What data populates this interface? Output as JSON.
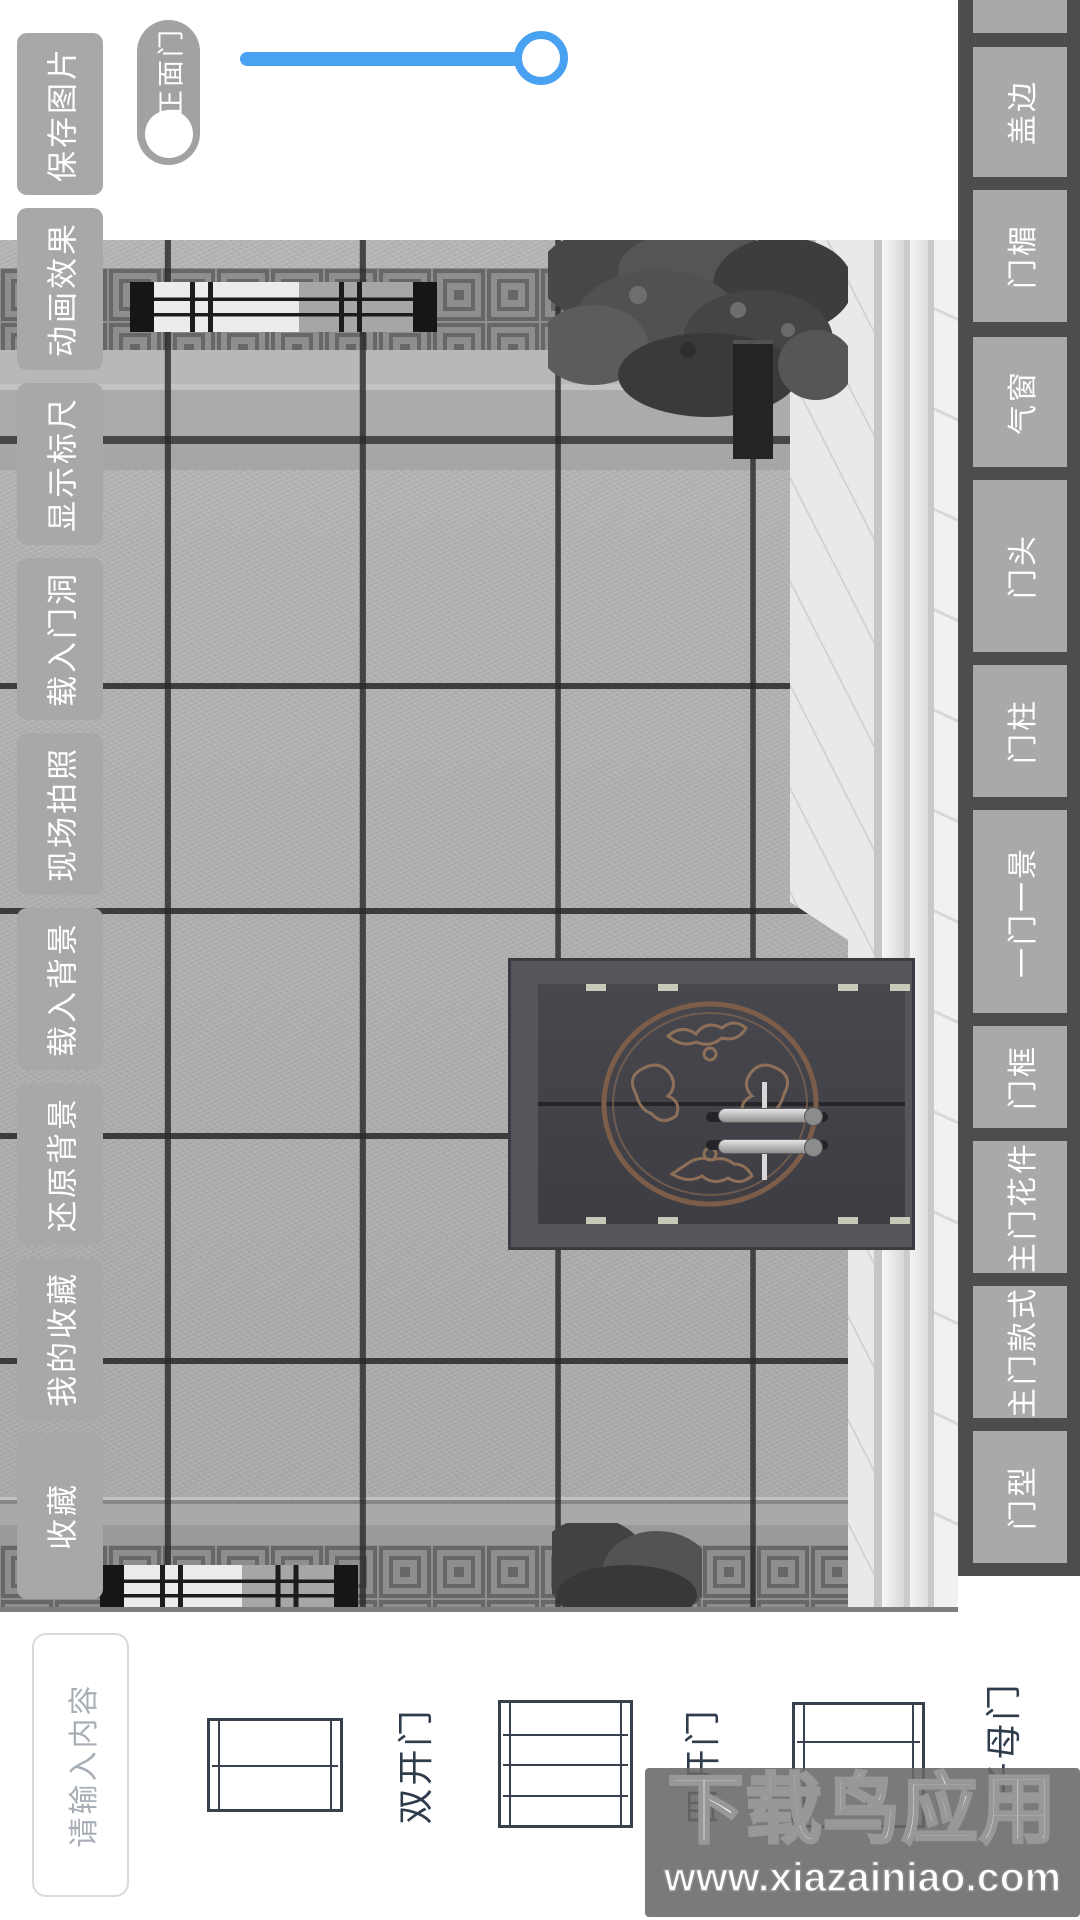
{
  "toolbar_left": {
    "items": [
      "保存图片",
      "动画效果",
      "显示标尺",
      "载入门洞",
      "现场拍照",
      "载入背景",
      "还原背景",
      "我的收藏",
      "收藏"
    ]
  },
  "front_door_toggle": {
    "label": "正面门",
    "checked": false
  },
  "zoom_slider": {
    "value_percent": 100
  },
  "panel_right": {
    "items": [
      "盖边",
      "门楣",
      "气窗",
      "门头",
      "门柱",
      "一门一景",
      "门框",
      "主门花件",
      "主门款式",
      "门型"
    ]
  },
  "bottom_bar": {
    "input_placeholder": "请输入内容",
    "door_types": [
      {
        "label": "双开门",
        "icon": "two-leaf-door-icon"
      },
      {
        "label": "四开门",
        "icon": "four-leaf-door-icon"
      },
      {
        "label": "子母门",
        "icon": "mother-child-door-icon"
      }
    ]
  },
  "watermark": {
    "title": "下载鸟应用",
    "url": "www.xiazainiao.com"
  },
  "colors": {
    "accent_blue": "#49a1f1",
    "button_gray": "#a8a8a8",
    "panel_dark": "#4d4d4d",
    "label_dark": "#2f3c4c",
    "watermark_bg": "#686868"
  }
}
